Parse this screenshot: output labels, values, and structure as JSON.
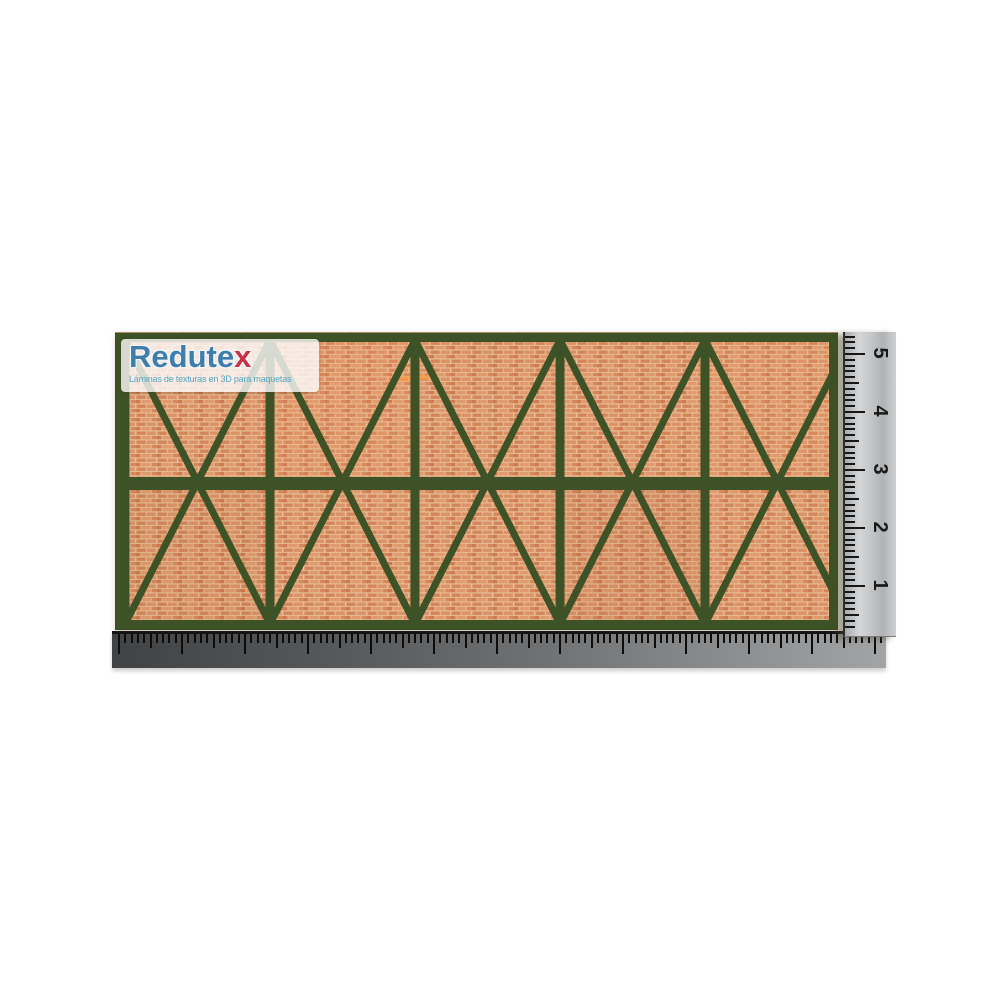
{
  "page": {
    "background": "#ffffff"
  },
  "logo": {
    "brand_main": "Redute",
    "brand_x": "x",
    "tagline": "Láminas de texturas en 3D para maquetas",
    "brand_color": "#3f7dab",
    "x_color": "#c93046",
    "tagline_color": "#55a5c2"
  },
  "texture_sheet": {
    "description": "half-timbered brick wall texture sheet, dark green timber truss over orange brick",
    "x": 115,
    "y": 332,
    "width": 723,
    "height": 298,
    "timber_color": "#3d5226",
    "brick_mortar": "#e6bd94",
    "brick_tones": [
      "#d4855a",
      "#dc9268",
      "#cf7a50",
      "#e09a6e",
      "#d5885c"
    ],
    "first_post": 10,
    "post_spacing": 145,
    "post_width": 9,
    "diag_width": 7,
    "beam_top": {
      "y": 1,
      "h": 9
    },
    "beam_mid": {
      "y": 145,
      "h": 13
    },
    "beam_bottom": {
      "y": 288,
      "h": 10
    },
    "row_split": 150
  },
  "vertical_ruler": {
    "x": 843,
    "y": 332,
    "width": 51,
    "height": 304,
    "numbers": [
      "5",
      "4",
      "3",
      "2",
      "1"
    ],
    "first_cm_y": 21,
    "cm_spacing": 58,
    "mm_spacing": 5.8,
    "tick_color": "#161616"
  },
  "bottom_ruler": {
    "x": 112,
    "y": 631,
    "width": 774,
    "height": 34,
    "tick_spacing": 6.3,
    "tick_color": "#0c0c0c"
  }
}
